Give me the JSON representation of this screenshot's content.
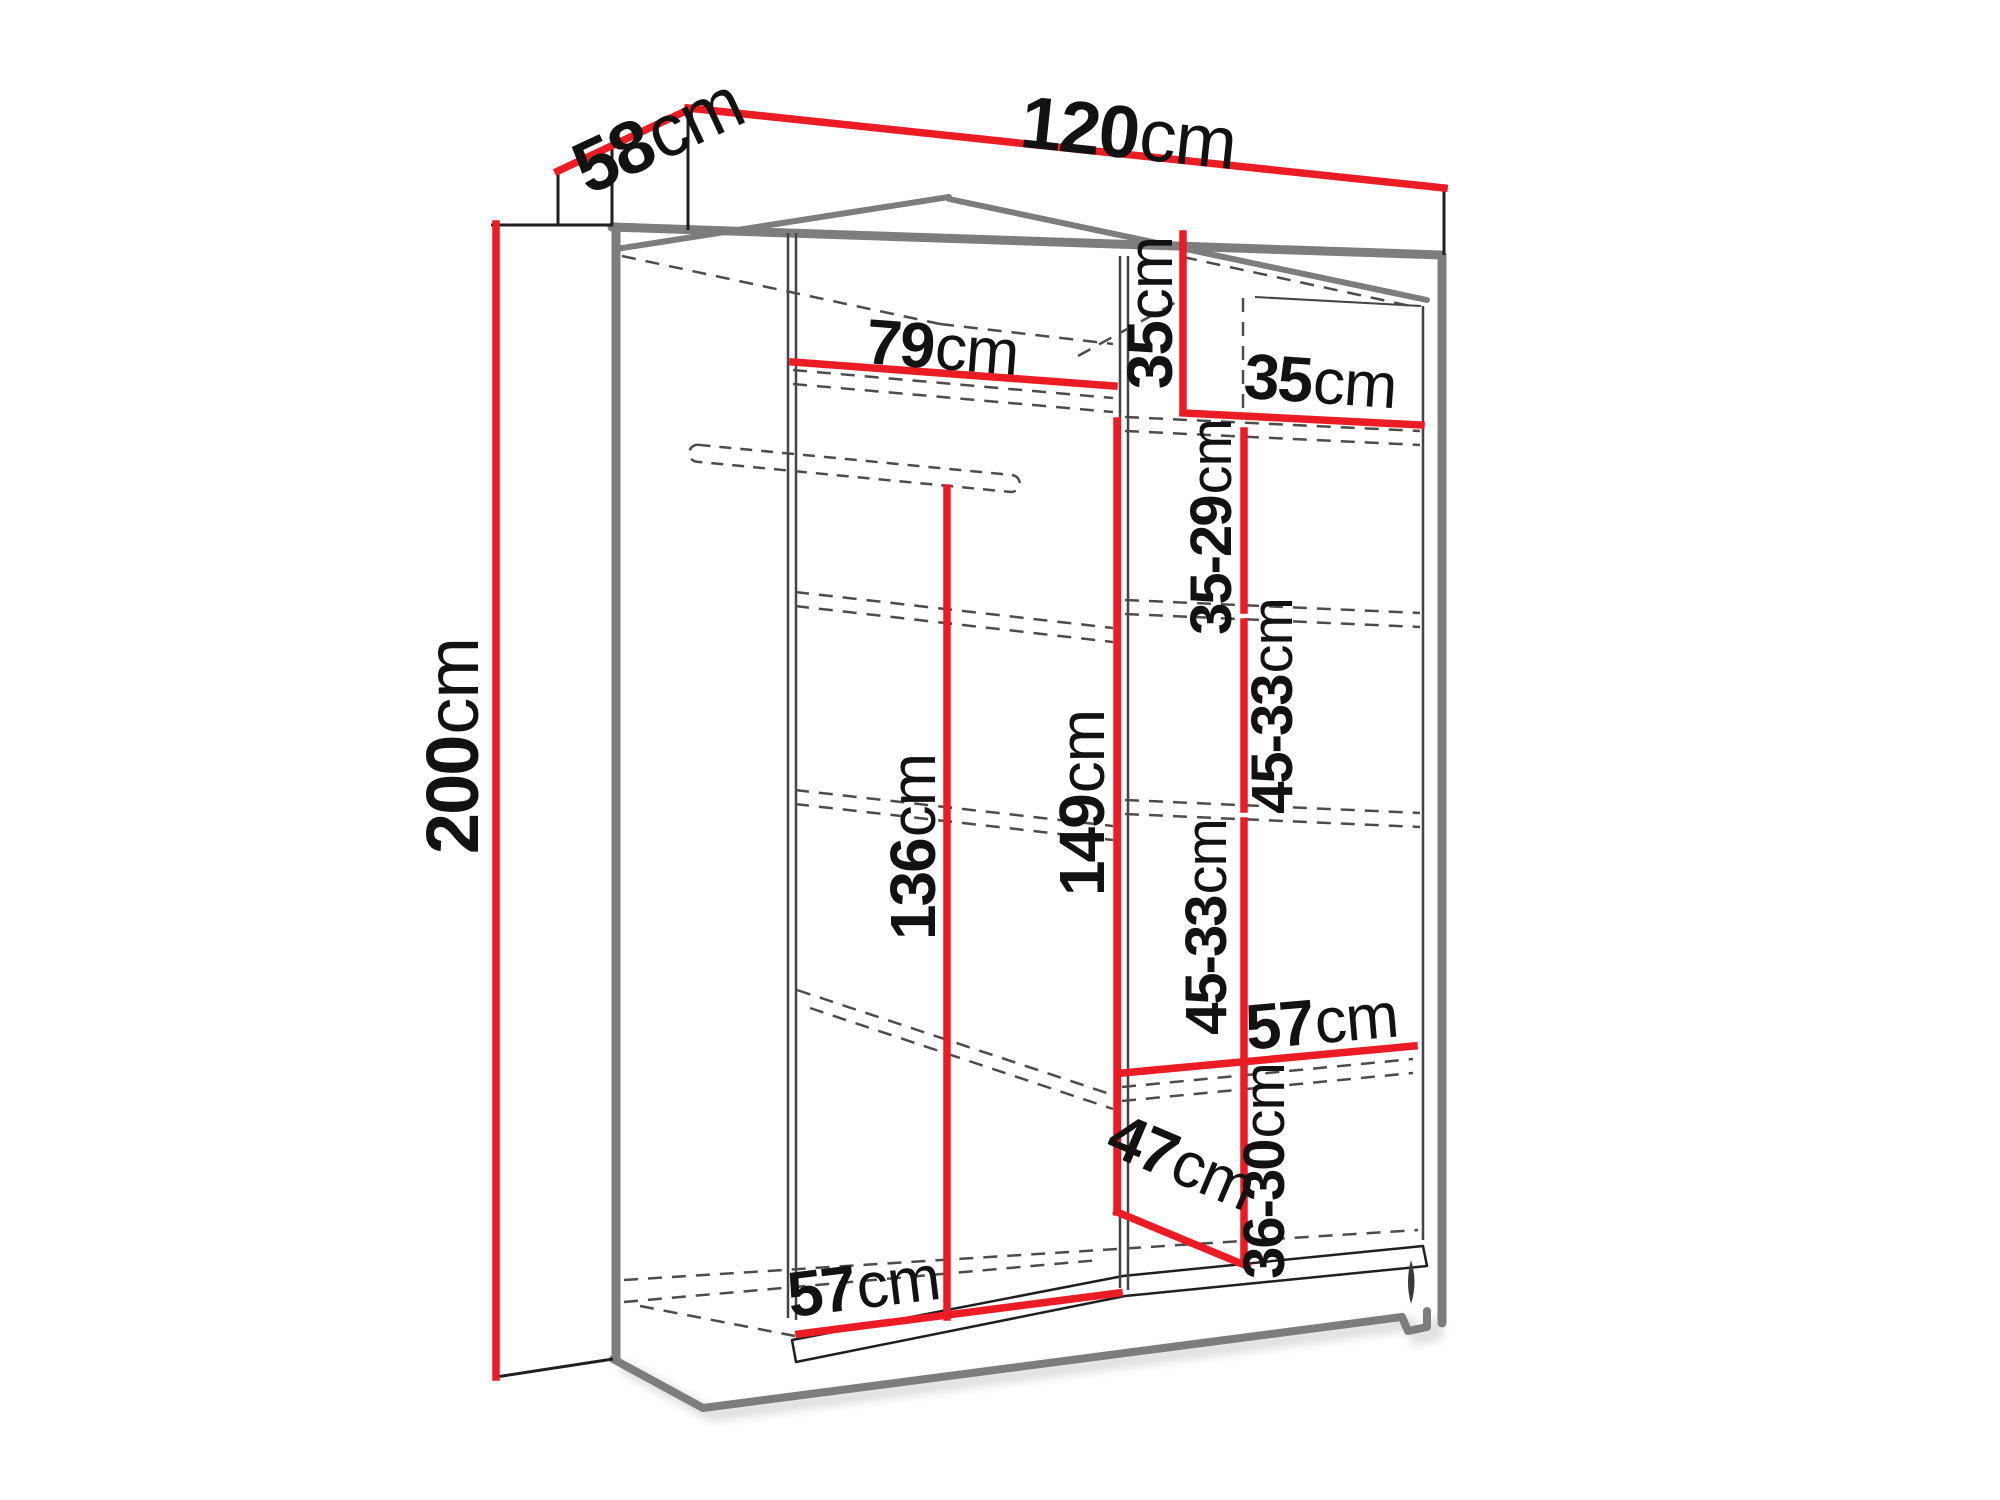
{
  "diagram": {
    "name": "wardrobe-dimension-diagram",
    "background": "#ffffff",
    "colors": {
      "dimension_red": "#ec1c24",
      "structure_gray": "#7d7d7d",
      "outline_black": "#1f1f1f",
      "inner_line": "#444444",
      "dashed_gray": "#4c4c4c",
      "shadow": "#c4c4c4",
      "text": "#121212"
    },
    "overall_dimensions": {
      "width": "120cm",
      "depth": "58cm",
      "height": "200cm"
    },
    "labels": [
      {
        "id": "depth-58",
        "value": "58",
        "unit": "cm",
        "x": 660,
        "y": 140,
        "rotate": -25,
        "size": 74
      },
      {
        "id": "width-120",
        "value": "120",
        "unit": "cm",
        "x": 1128,
        "y": 138,
        "rotate": 6,
        "size": 74
      },
      {
        "id": "height-200",
        "value": "200",
        "unit": "cm",
        "x": 458,
        "y": 746,
        "rotate": -90,
        "size": 74
      },
      {
        "id": "rail-width-79",
        "value": "79",
        "unit": "cm",
        "x": 942,
        "y": 352,
        "rotate": 4.5,
        "size": 64
      },
      {
        "id": "cubby-height-35",
        "value": "35",
        "unit": "cm",
        "x": 1155,
        "y": 313,
        "rotate": -90,
        "size": 64
      },
      {
        "id": "cubby-width-35",
        "value": "35",
        "unit": "cm",
        "x": 1320,
        "y": 386,
        "rotate": 4,
        "size": 64
      },
      {
        "id": "gap-35-29",
        "value": "35-29",
        "unit": "cm",
        "x": 1216,
        "y": 527,
        "rotate": -90,
        "size": 58
      },
      {
        "id": "gap-45-33-a",
        "value": "45-33",
        "unit": "cm",
        "x": 1277,
        "y": 706,
        "rotate": -90,
        "size": 58
      },
      {
        "id": "clearance-136",
        "value": "136",
        "unit": "cm",
        "x": 918,
        "y": 847,
        "rotate": -90,
        "size": 64
      },
      {
        "id": "clearance-149",
        "value": "149",
        "unit": "cm",
        "x": 1087,
        "y": 803,
        "rotate": -90,
        "size": 64
      },
      {
        "id": "gap-45-33-b",
        "value": "45-33",
        "unit": "cm",
        "x": 1211,
        "y": 927,
        "rotate": -90,
        "size": 58
      },
      {
        "id": "shelf-depth-57",
        "value": "57",
        "unit": "cm",
        "x": 1322,
        "y": 1026,
        "rotate": -5,
        "size": 64
      },
      {
        "id": "gap-36-30",
        "value": "36-30",
        "unit": "cm",
        "x": 1269,
        "y": 1171,
        "rotate": -90,
        "size": 58
      },
      {
        "id": "diag-47",
        "value": "47",
        "unit": "cm",
        "x": 1180,
        "y": 1166,
        "rotate": 23,
        "size": 64
      },
      {
        "id": "bottom-width-57",
        "value": "57",
        "unit": "cm",
        "x": 864,
        "y": 1291,
        "rotate": -7,
        "size": 64
      }
    ],
    "red_lines": [
      {
        "id": "depth-line-58",
        "x1": 558,
        "y1": 171,
        "x2": 690,
        "y2": 109
      },
      {
        "id": "width-line-120",
        "x1": 688,
        "y1": 108,
        "x2": 1444,
        "y2": 188
      },
      {
        "id": "height-line-200",
        "x1": 496,
        "y1": 224,
        "x2": 496,
        "y2": 1377
      },
      {
        "id": "rail-line-79",
        "x1": 793,
        "y1": 362,
        "x2": 1114,
        "y2": 386
      },
      {
        "id": "cubby-height-line",
        "x1": 1183,
        "y1": 234,
        "x2": 1183,
        "y2": 412
      },
      {
        "id": "cubby-width-line",
        "x1": 1183,
        "y1": 413,
        "x2": 1421,
        "y2": 425
      },
      {
        "id": "col-seg-35-29",
        "x1": 1244,
        "y1": 431,
        "x2": 1244,
        "y2": 610
      },
      {
        "id": "col-seg-45-33-a",
        "x1": 1244,
        "y1": 622,
        "x2": 1244,
        "y2": 809
      },
      {
        "id": "col-seg-45-33-36-30",
        "x1": 1244,
        "y1": 821,
        "x2": 1244,
        "y2": 1263
      },
      {
        "id": "shelf-depth-line-57",
        "x1": 1122,
        "y1": 1073,
        "x2": 1414,
        "y2": 1046
      },
      {
        "id": "clearance-line-136",
        "x1": 947,
        "y1": 488,
        "x2": 947,
        "y2": 1317
      },
      {
        "id": "clearance-line-149",
        "x1": 1117,
        "y1": 421,
        "x2": 1117,
        "y2": 1212
      },
      {
        "id": "diag-line-47",
        "x1": 1117,
        "y1": 1212,
        "x2": 1247,
        "y2": 1266
      },
      {
        "id": "bottom-line-57",
        "x1": 799,
        "y1": 1334,
        "x2": 1119,
        "y2": 1293
      }
    ],
    "gray_lines": [
      {
        "id": "carcass-left-edge",
        "w": 9,
        "points": [
          [
            616,
            227
          ],
          [
            616,
            1359
          ]
        ]
      },
      {
        "id": "carcass-top-edge",
        "w": 9,
        "points": [
          [
            612,
            227
          ],
          [
            1441,
            255
          ]
        ]
      },
      {
        "id": "carcass-right-edge",
        "w": 9,
        "points": [
          [
            1442,
            255
          ],
          [
            1442,
            1323
          ]
        ]
      },
      {
        "id": "carcass-bottom-edge",
        "w": 8,
        "points": [
          [
            613,
            1359
          ],
          [
            703,
            1408
          ],
          [
            1402,
            1317
          ],
          [
            1408,
            1331
          ],
          [
            1427,
            1327
          ],
          [
            1427,
            1311
          ]
        ]
      },
      {
        "id": "ceiling-back-left",
        "w": 6,
        "points": [
          [
            616,
            249
          ],
          [
            949,
            197
          ]
        ]
      },
      {
        "id": "ceiling-back-right",
        "w": 6,
        "points": [
          [
            949,
            199
          ],
          [
            1427,
            300
          ]
        ]
      }
    ],
    "black_lines": [
      {
        "id": "top-panel-left-edge",
        "w": 3,
        "points": [
          [
            558,
            171
          ],
          [
            558,
            226
          ]
        ]
      },
      {
        "id": "height-tick-top",
        "w": 3,
        "points": [
          [
            491,
            225
          ],
          [
            613,
            225
          ]
        ]
      },
      {
        "id": "top-panel-corner-edge",
        "w": 3,
        "points": [
          [
            688,
            109
          ],
          [
            688,
            230
          ]
        ]
      },
      {
        "id": "top-panel-front-left",
        "w": 3,
        "points": [
          [
            612,
            147
          ],
          [
            612,
            226
          ]
        ]
      },
      {
        "id": "top-panel-right-edge",
        "w": 3,
        "points": [
          [
            1444,
            188
          ],
          [
            1444,
            255
          ]
        ]
      },
      {
        "id": "height-tick-bottom",
        "w": 3,
        "points": [
          [
            496,
            1377
          ],
          [
            613,
            1359
          ]
        ]
      },
      {
        "id": "left-wall-inner-a",
        "w": 2.5,
        "points": [
          [
            788,
            233
          ],
          [
            788,
            1318
          ]
        ]
      },
      {
        "id": "left-wall-inner-b",
        "w": 2.5,
        "points": [
          [
            796,
            233
          ],
          [
            796,
            1320
          ]
        ]
      },
      {
        "id": "divider-a",
        "w": 2.5,
        "points": [
          [
            1120,
            256
          ],
          [
            1120,
            1288
          ]
        ]
      },
      {
        "id": "divider-b",
        "w": 2.5,
        "points": [
          [
            1128,
            256
          ],
          [
            1128,
            1290
          ]
        ]
      },
      {
        "id": "right-wall-inner",
        "w": 2.5,
        "points": [
          [
            1423,
            306
          ],
          [
            1423,
            1240
          ]
        ]
      },
      {
        "id": "ceiling-right-thin",
        "w": 2,
        "points": [
          [
            1255,
            297
          ],
          [
            1421,
            306
          ]
        ]
      }
    ],
    "dashed_lines": [
      {
        "id": "ceiling-hidden-left",
        "points": [
          [
            622,
            256
          ],
          [
            940,
            324
          ]
        ]
      },
      {
        "id": "ceiling-hidden-mid",
        "points": [
          [
            940,
            324
          ],
          [
            1113,
            344
          ]
        ]
      },
      {
        "id": "ceiling-hidden-right",
        "points": [
          [
            1183,
            257
          ],
          [
            1415,
            307
          ]
        ]
      },
      {
        "id": "cubby-corner-up",
        "points": [
          [
            1078,
            356
          ],
          [
            1180,
            300
          ]
        ]
      },
      {
        "id": "cubby-back-vertical",
        "points": [
          [
            1243,
            298
          ],
          [
            1243,
            410
          ]
        ]
      },
      {
        "id": "top-shelf-back-a",
        "points": [
          [
            793,
            370
          ],
          [
            1113,
            398
          ]
        ]
      },
      {
        "id": "top-shelf-back-b",
        "points": [
          [
            793,
            384
          ],
          [
            1113,
            412
          ]
        ]
      },
      {
        "id": "shelf-a-front",
        "points": [
          [
            1125,
            417
          ],
          [
            1420,
            431
          ]
        ]
      },
      {
        "id": "shelf-a-back",
        "points": [
          [
            1125,
            431
          ],
          [
            1420,
            445
          ]
        ]
      },
      {
        "id": "shelf-b-left-a",
        "points": [
          [
            795,
            592
          ],
          [
            1113,
            628
          ]
        ]
      },
      {
        "id": "shelf-b-left-b",
        "points": [
          [
            795,
            606
          ],
          [
            1113,
            642
          ]
        ]
      },
      {
        "id": "shelf-b-front",
        "points": [
          [
            1125,
            600
          ],
          [
            1420,
            613
          ]
        ]
      },
      {
        "id": "shelf-b-back",
        "points": [
          [
            1125,
            614
          ],
          [
            1420,
            627
          ]
        ]
      },
      {
        "id": "shelf-c-left-a",
        "points": [
          [
            795,
            790
          ],
          [
            1113,
            826
          ]
        ]
      },
      {
        "id": "shelf-c-left-b",
        "points": [
          [
            795,
            804
          ],
          [
            1113,
            840
          ]
        ]
      },
      {
        "id": "shelf-c-front",
        "points": [
          [
            1125,
            800
          ],
          [
            1420,
            813
          ]
        ]
      },
      {
        "id": "shelf-c-back",
        "points": [
          [
            1125,
            814
          ],
          [
            1420,
            827
          ]
        ]
      },
      {
        "id": "shelf-d-left-a",
        "points": [
          [
            797,
            990
          ],
          [
            1113,
            1095
          ]
        ]
      },
      {
        "id": "shelf-d-left-b",
        "points": [
          [
            810,
            1008
          ],
          [
            1113,
            1109
          ]
        ]
      },
      {
        "id": "shelf-d-front",
        "points": [
          [
            1122,
            1087
          ],
          [
            1413,
            1059
          ]
        ]
      },
      {
        "id": "shelf-d-back",
        "points": [
          [
            1122,
            1101
          ],
          [
            1413,
            1073
          ]
        ]
      },
      {
        "id": "floor-back-edge",
        "points": [
          [
            624,
            1280
          ],
          [
            1418,
            1230
          ]
        ]
      },
      {
        "id": "floor-mid-edge",
        "points": [
          [
            624,
            1302
          ],
          [
            1100,
            1260
          ]
        ]
      },
      {
        "id": "floor-front-left",
        "points": [
          [
            640,
            1306
          ],
          [
            795,
            1336
          ]
        ]
      }
    ],
    "hanging_rail": {
      "id": "hanging-rail",
      "x": 690,
      "y": 444,
      "width": 332,
      "height": 17,
      "rx": 8.5,
      "rotate": 5.5
    },
    "floor_bar": {
      "id": "bottom-panel",
      "path": "M792,1340 L1123,1276 L1423,1246 L1427,1266 L1125,1296 L796,1362 Z"
    },
    "foot_gap": {
      "id": "foot-gap",
      "path": "M1411,1260 Q1418,1282 1411,1304 Q1405,1282 1411,1260 Z"
    }
  }
}
